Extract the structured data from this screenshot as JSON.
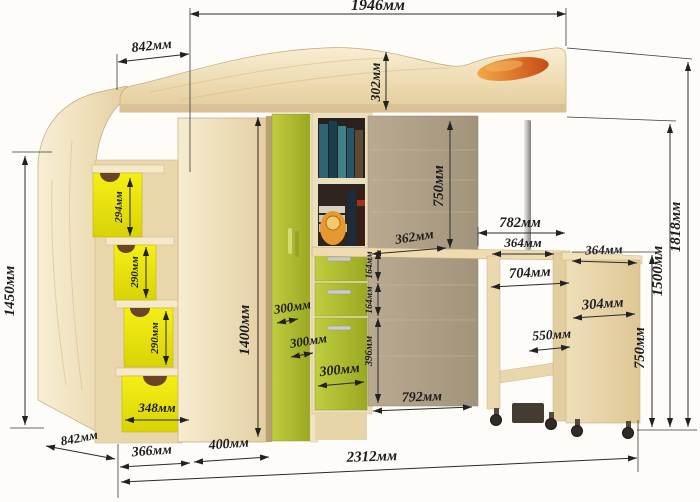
{
  "diagram": {
    "kind": "furniture-dimension-drawing",
    "product": "loft-bed-with-corner-wardrobe-stair-drawers-and-mobile-desk",
    "unit_suffix": "мм"
  },
  "colors": {
    "wood_light": "#efdeb6",
    "wood_dark_back": "#ac9d85",
    "accent_green": "#aeba2e",
    "accent_yellow": "#ece50f",
    "pillow_orange": "#d96f26",
    "dimension_ink": "#1c1c1c",
    "background": "#fdfcf9"
  },
  "dims": {
    "bed_length": "1946мм",
    "bed_depth_top": "842мм",
    "headboard_height": "302мм",
    "under_bed_clearance": "750мм",
    "side_panel_height": "1450мм",
    "step1_height": "294мм",
    "step2_height": "290мм",
    "step3_height": "290мм",
    "base_drawer_width": "348мм",
    "wardrobe_height": "1400мм",
    "door_depth_a": "300мм",
    "door_depth_b": "300мм",
    "drawer_width": "300мм",
    "drawer1_height": "164мм",
    "drawer2_height": "164мм",
    "lower_door_height": "396мм",
    "desk_depth": "362мм",
    "niche_width": "782мм",
    "table_left_top": "364мм",
    "table_right_top": "364мм",
    "table_inner_width": "704мм",
    "table_right_depth": "304мм",
    "table_opening": "550мм",
    "under_desk_width": "792мм",
    "height_to_desk": "750мм",
    "height_to_bed_base": "1500мм",
    "height_total": "1818мм",
    "base_side_depth": "842мм",
    "base_stairs_width": "366мм",
    "base_door_width": "400мм",
    "total_width": "2312мм"
  }
}
